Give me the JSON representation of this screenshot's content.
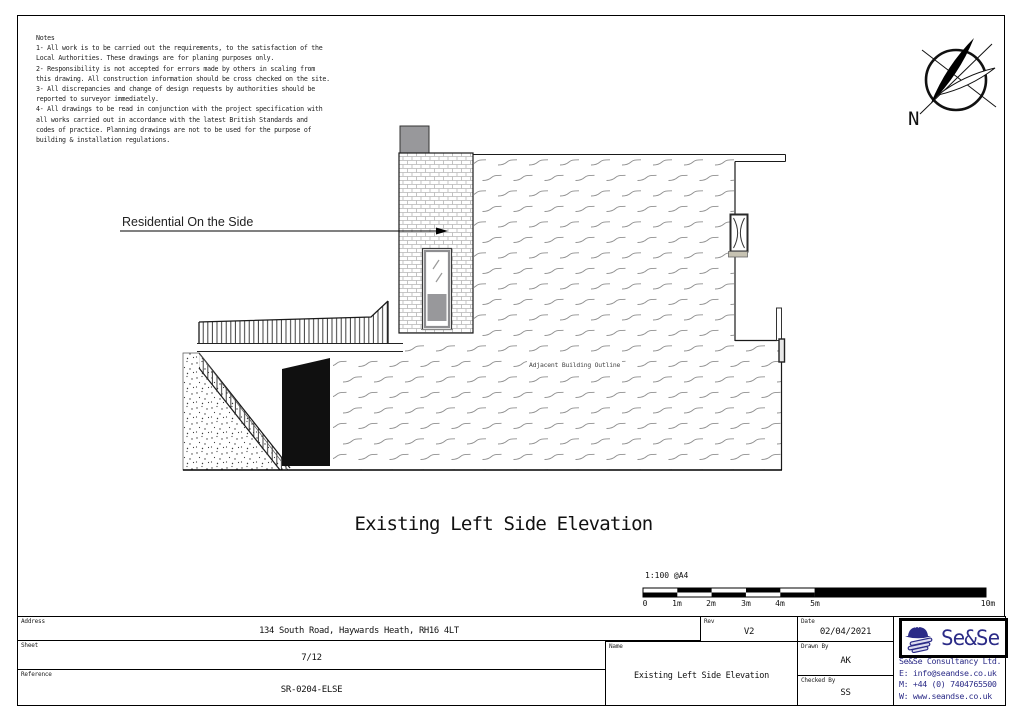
{
  "notes": {
    "title": "Notes",
    "lines": [
      "1- All work is to be carried out the requirements, to the satisfaction of the",
      "Local Authorities. These drawings are for planing purposes only.",
      "2- Responsibility is not accepted for errors made by others in scaling from",
      "this drawing. All construction information should be cross checked on the site.",
      "3- All discrepancies and change of design requests by authorities should be",
      "reported to surveyor immediately.",
      "4- All drawings to be read in conjunction with the project specification with",
      "all works carried out in accordance with the latest British Standards and",
      "codes of practice. Planning drawings are not to be used for the purpose of",
      "building & installation regulations."
    ]
  },
  "compass": {
    "label": "N"
  },
  "annotation": {
    "residential_label": "Residential On the Side"
  },
  "drawing_labels": {
    "adjacent": "Adjacent Building Outline"
  },
  "title": "Existing Left Side Elevation",
  "scale_bar": {
    "scale_label": "1:100 @A4",
    "ticks": [
      "0",
      "1m",
      "2m",
      "3m",
      "4m",
      "5m",
      "10m"
    ]
  },
  "title_block": {
    "address": {
      "label": "Address",
      "value": "134 South Road, Haywards Heath, RH16 4LT"
    },
    "sheet": {
      "label": "Sheet",
      "value": "7/12"
    },
    "reference": {
      "label": "Reference",
      "value": "SR-0204-ELSE"
    },
    "name": {
      "label": "Name",
      "value": "Existing Left Side Elevation"
    },
    "rev": {
      "label": "Rev",
      "value": "V2"
    },
    "date": {
      "label": "Date",
      "value": "02/04/2021"
    },
    "drawn_by": {
      "label": "Drawn By",
      "value": "AK"
    },
    "checked_by": {
      "label": "Checked By",
      "value": "SS"
    },
    "company": {
      "logo_text": "Se&Se",
      "name": "Se&Se Consultancy Ltd.",
      "email": "E: info@seandse.co.uk",
      "mobile": "M: +44 (0) 7404765500",
      "web": "W: www.seandse.co.uk",
      "brand_color": "#2b2b87"
    }
  },
  "colors": {
    "brand_navy": "#2b2b87",
    "chimney_gray": "#98989b",
    "sill_beige": "#c6c2b2"
  }
}
